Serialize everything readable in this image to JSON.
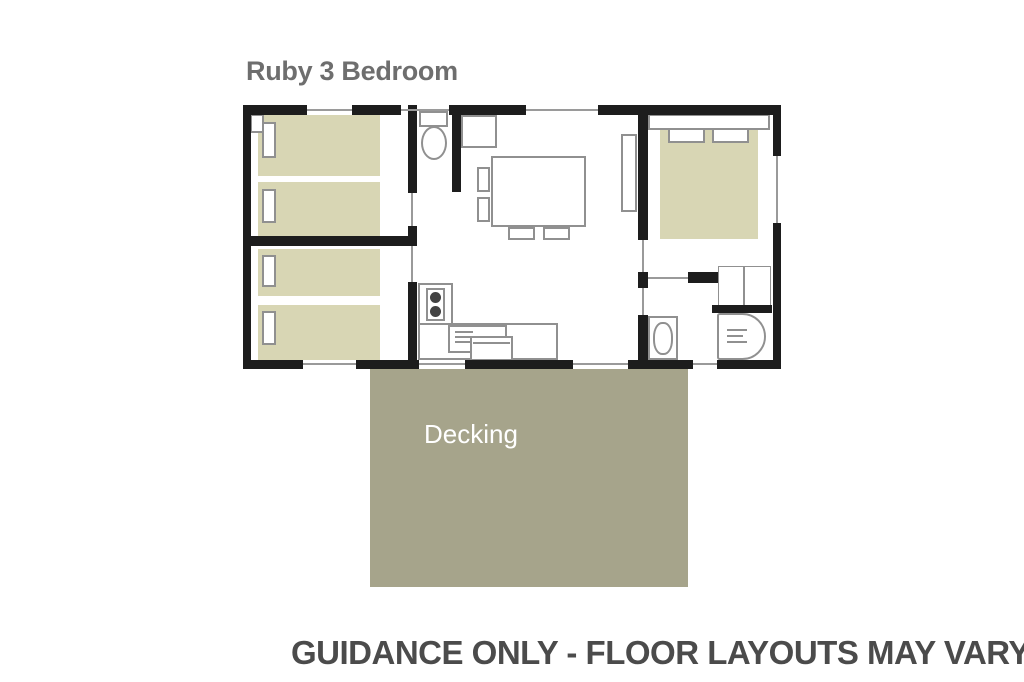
{
  "title": {
    "text": "Ruby 3 Bedroom",
    "color": "#6e6e6e"
  },
  "deck": {
    "label": "Decking",
    "text_color": "#ffffff",
    "fill": "#a6a48b"
  },
  "disclaimer": {
    "text": "GUIDANCE ONLY - FLOOR LAYOUTS MAY VARY",
    "color": "#4b4b4b"
  },
  "plan": {
    "wall_color": "#1d1d1d",
    "bed_fill": "#d8d6b4",
    "furniture_outline": "#909090",
    "window_line": "#9a9a9a",
    "rooms": [
      {
        "name": "twin-bedroom-front",
        "furniture": [
          "single-bed",
          "single-bed",
          "pillow",
          "pillow",
          "corner-shelf"
        ]
      },
      {
        "name": "twin-bedroom-rear",
        "furniture": [
          "single-bed",
          "single-bed",
          "pillow",
          "pillow"
        ]
      },
      {
        "name": "wc",
        "furniture": [
          "toilet"
        ]
      },
      {
        "name": "living-dining",
        "furniture": [
          "bench-seat",
          "dining-table",
          "chair",
          "chair",
          "chair",
          "chair",
          "sofa"
        ]
      },
      {
        "name": "kitchen",
        "furniture": [
          "worktop",
          "hob",
          "sink-drainer",
          "appliance"
        ]
      },
      {
        "name": "double-bedroom",
        "furniture": [
          "headboard",
          "pillow",
          "pillow",
          "double-bed",
          "wardrobe"
        ]
      },
      {
        "name": "shower-room",
        "furniture": [
          "toilet",
          "shower"
        ]
      }
    ]
  }
}
